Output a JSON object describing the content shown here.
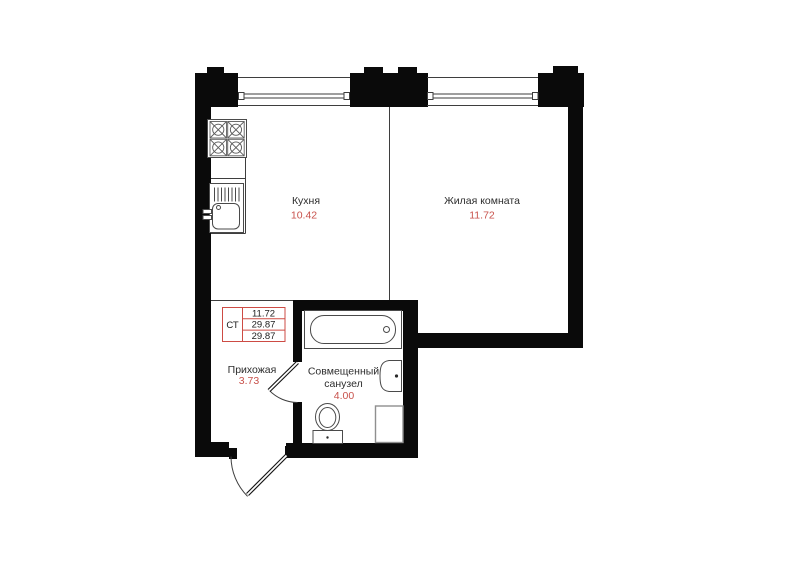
{
  "palette": {
    "wall": "#0a0a0a",
    "thin_line": "#3e3e3e",
    "label_text": "#2d2d2d",
    "accent": "#c8524c",
    "stamp_border": "#cd4b44"
  },
  "plan": {
    "rooms": [
      {
        "id": "kitchen",
        "name": "Кухня",
        "area": "10.42"
      },
      {
        "id": "living-room",
        "name": "Жилая комната",
        "area": "11.72"
      },
      {
        "id": "hallway",
        "name": "Прихожая",
        "area": "3.73"
      },
      {
        "id": "bathroom",
        "name_line1": "Совмещенный",
        "name_line2": "санузел",
        "area": "4.00"
      }
    ],
    "stamp": {
      "type": "СТ",
      "rows": [
        "11.72",
        "29.87",
        "29.87"
      ]
    },
    "fixtures": [
      "stove-icon",
      "kitchen-sink-icon",
      "bathtub-icon",
      "washbasin-icon",
      "toilet-icon",
      "washing-machine-icon"
    ],
    "doors": [
      "entry-door",
      "bathroom-door"
    ],
    "window_count": 2
  }
}
